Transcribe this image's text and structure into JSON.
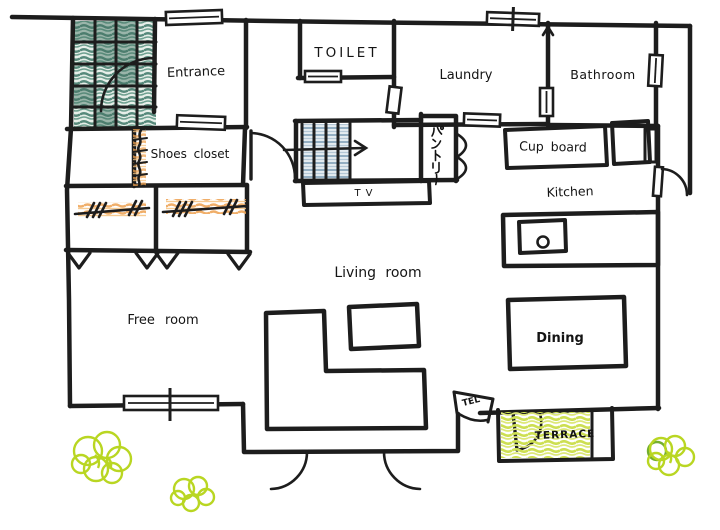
{
  "diagram": {
    "type": "hand-drawn house floor plan"
  },
  "rooms": {
    "entrance": {
      "label": "Entrance"
    },
    "toilet": {
      "label": "TOILET"
    },
    "laundry": {
      "label": "Laundry"
    },
    "bathroom": {
      "label": "Bathroom"
    },
    "shoes_closet": {
      "label": "Shoes closet"
    },
    "pantry": {
      "label": "パントリー"
    },
    "cupboard": {
      "label": "Cup board"
    },
    "kitchen": {
      "label": "Kitchen"
    },
    "living_room": {
      "label": "Living room"
    },
    "free_room": {
      "label": "Free room"
    },
    "dining": {
      "label": "Dining"
    },
    "terrace": {
      "label": "TERRACE"
    }
  },
  "fixtures": {
    "tv": {
      "label": "TV"
    },
    "tel": {
      "label": "TEL"
    }
  },
  "colors": {
    "wall": "#1d1d1d",
    "ink": "#141414",
    "porch_tile": "#57897b",
    "stair_tread": "#93aec2",
    "closet_accent": "#eda04e",
    "tv_board": "#ecbf7d",
    "sofa": "#55786a",
    "coffee_table": "#eda45c",
    "dining_table": "#e8913d",
    "sink": "#58aedd",
    "terrace_floor": "#cddf52",
    "bush": "#b9d622",
    "bush_dark": "#74af2e"
  }
}
